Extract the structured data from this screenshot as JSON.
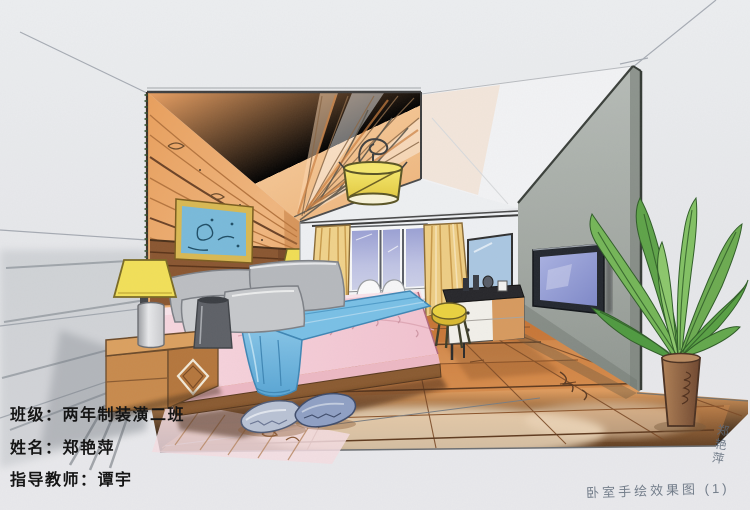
{
  "annotations": {
    "class_line": "班级：两年制装潢二班",
    "name_line": "姓名：郑艳萍",
    "teacher_line": "指导教师：谭宇",
    "caption_handwritten": "卧室手绘效果图 (1)",
    "signature_vertical": "郑艳萍"
  },
  "palette": {
    "paper": "#e7e8ea",
    "wood_wall": "#eda869",
    "ceiling_panel": "#f0b478",
    "headboard_wood": "#8a5630",
    "bedding_pink": "#f5ccd6",
    "throw_blue": "#79c0e6",
    "pillow_gray": "#bcbec2",
    "curtain_yellow": "#eecd84",
    "window_glass": "#b4b8dc",
    "lamp_shade_yellow": "#f2e058",
    "floor_wood": "#d98c4a",
    "partition_gray": "#a7ada7",
    "tv_screen": "#97a0d8",
    "plant_green": "#5fa648",
    "stool_yellow": "#e8d23e",
    "ink_black": "#151515",
    "pencil_gray": "#5f6b7a"
  }
}
